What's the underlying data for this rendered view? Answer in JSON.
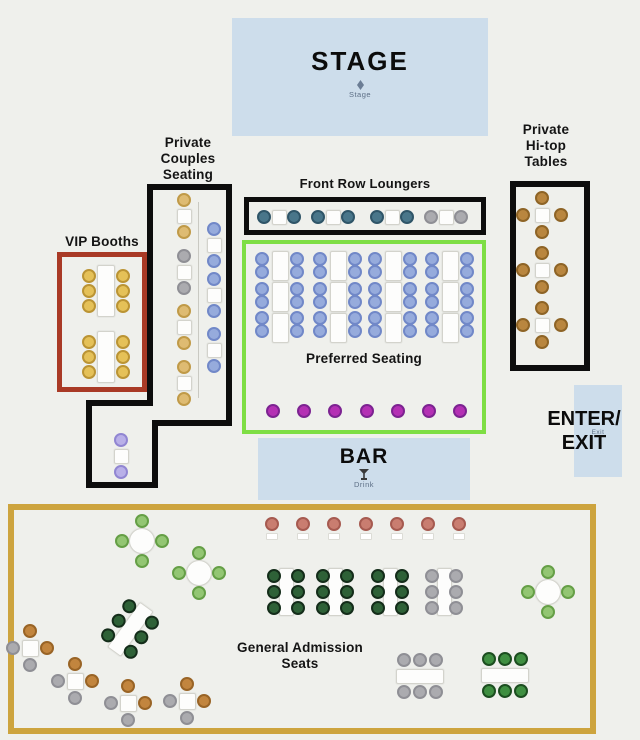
{
  "zones": {
    "stage": {
      "label": "STAGE",
      "sublabel": "Stage"
    },
    "private_couples": {
      "label_lines": [
        "Private",
        "Couples",
        "Seating"
      ]
    },
    "vip_booths": {
      "label": "VIP Booths"
    },
    "front_row": {
      "label": "Front Row Loungers"
    },
    "preferred": {
      "label": "Preferred Seating"
    },
    "hitop": {
      "label_lines": [
        "Private",
        "Hi-top",
        "Tables"
      ]
    },
    "enter_exit": {
      "label_lines": [
        "ENTER/",
        "EXIT"
      ],
      "sublabel": "Exit"
    },
    "bar": {
      "label": "BAR",
      "sublabel": "Drink"
    },
    "general_admission": {
      "label_lines": [
        "General Admission",
        "Seats"
      ]
    }
  },
  "colors": {
    "background": "#eff0ec",
    "area_blue": "#cdddeb",
    "outline_black": "#0d0d0d",
    "outline_red": "#a93a26",
    "outline_green": "#7ede44",
    "outline_gold": "#cda43e"
  },
  "seat_map": {
    "seat_colors": {
      "gold": {
        "fill": "#e5c158",
        "ring": "#bb9434"
      },
      "tan": {
        "fill": "#debb72",
        "ring": "#c09a48"
      },
      "gray": {
        "fill": "#ababaf",
        "ring": "#8f8f95"
      },
      "blue": {
        "fill": "#96abdc",
        "ring": "#7188c8"
      },
      "teal": {
        "fill": "#49768a",
        "ring": "#2f5568"
      },
      "lavender": {
        "fill": "#b9b0e8",
        "ring": "#9186d2"
      },
      "magenta": {
        "fill": "#b430b4",
        "ring": "#7c2391"
      },
      "salmon": {
        "fill": "#c97d70",
        "ring": "#a65a50"
      },
      "ltgreen": {
        "fill": "#93c673",
        "ring": "#659f46"
      },
      "dkgreen": {
        "fill": "#2e6137",
        "ring": "#142d1a"
      },
      "mdgreen": {
        "fill": "#3f8f41",
        "ring": "#1c4e20"
      },
      "orange": {
        "fill": "#c2853e",
        "ring": "#996426"
      },
      "brown": {
        "fill": "#b9863f",
        "ring": "#8e6426"
      }
    },
    "preferred": {
      "groups_x": [
        280,
        338,
        393,
        450
      ],
      "rect_ys": [
        266,
        297,
        328
      ],
      "seat_ys": [
        259,
        272,
        289,
        302,
        318,
        331
      ],
      "c": "blue"
    },
    "elements": [
      {
        "t": "couple_v",
        "x": 184,
        "y": 216,
        "c": "tan"
      },
      {
        "t": "couple_v",
        "x": 184,
        "y": 272,
        "c": "gray"
      },
      {
        "t": "couple_v",
        "x": 184,
        "y": 327,
        "c": "tan"
      },
      {
        "t": "couple_v",
        "x": 184,
        "y": 383,
        "c": "tan"
      },
      {
        "t": "couple_v",
        "x": 214,
        "y": 245,
        "c": "blue"
      },
      {
        "t": "couple_v",
        "x": 214,
        "y": 295,
        "c": "blue"
      },
      {
        "t": "couple_v",
        "x": 214,
        "y": 350,
        "c": "blue"
      },
      {
        "t": "couple_v",
        "x": 121,
        "y": 456,
        "c": "lavender"
      },
      {
        "t": "couple_h",
        "x": 279,
        "y": 217,
        "c": "teal"
      },
      {
        "t": "couple_h",
        "x": 333,
        "y": 217,
        "c": "teal"
      },
      {
        "t": "couple_h",
        "x": 392,
        "y": 217,
        "c": "teal"
      },
      {
        "t": "couple_h",
        "x": 446,
        "y": 217,
        "c": "gray"
      },
      {
        "t": "booth",
        "x": 106,
        "y": 291,
        "c": "gold"
      },
      {
        "t": "booth",
        "x": 106,
        "y": 357,
        "c": "gold"
      },
      {
        "t": "hitop",
        "x": 542,
        "y": 215,
        "c": "brown"
      },
      {
        "t": "hitop",
        "x": 542,
        "y": 270,
        "c": "brown"
      },
      {
        "t": "hitop",
        "x": 542,
        "y": 325,
        "c": "brown"
      },
      {
        "t": "row",
        "y": 411,
        "xs": [
          273,
          304,
          335,
          367,
          398,
          429,
          460
        ],
        "c": "magenta",
        "chip": false
      },
      {
        "t": "row",
        "y": 524,
        "xs": [
          272,
          303,
          334,
          366,
          397,
          428,
          459
        ],
        "c": "salmon",
        "chip": true
      },
      {
        "t": "round4",
        "x": 142,
        "y": 541,
        "c": "ltgreen"
      },
      {
        "t": "round4",
        "x": 199,
        "y": 573,
        "c": "ltgreen"
      },
      {
        "t": "round4",
        "x": 548,
        "y": 592,
        "c": "ltgreen"
      },
      {
        "t": "banquet_v",
        "x": 286,
        "y": 592,
        "c": "dkgreen"
      },
      {
        "t": "banquet_v",
        "x": 335,
        "y": 592,
        "c": "dkgreen"
      },
      {
        "t": "banquet_v",
        "x": 390,
        "y": 592,
        "c": "dkgreen"
      },
      {
        "t": "banquet_v",
        "x": 444,
        "y": 592,
        "c": "gray"
      },
      {
        "t": "banquet_h",
        "x": 420,
        "y": 676,
        "c": "gray"
      },
      {
        "t": "banquet_h",
        "x": 505,
        "y": 675,
        "c": "mdgreen"
      },
      {
        "t": "banquet_rot",
        "x": 130,
        "y": 629,
        "rot": 36,
        "c": "dkgreen"
      },
      {
        "t": "square4",
        "x": 30,
        "y": 648,
        "top": "orange",
        "right": "orange",
        "left": "gray",
        "bottom": "gray"
      },
      {
        "t": "square4",
        "x": 75,
        "y": 681,
        "top": "orange",
        "right": "orange",
        "left": "gray",
        "bottom": "gray"
      },
      {
        "t": "square4",
        "x": 128,
        "y": 703,
        "top": "orange",
        "right": "orange",
        "left": "gray",
        "bottom": "gray"
      },
      {
        "t": "square4",
        "x": 187,
        "y": 701,
        "top": "orange",
        "right": "orange",
        "left": "gray",
        "bottom": "gray"
      }
    ]
  }
}
